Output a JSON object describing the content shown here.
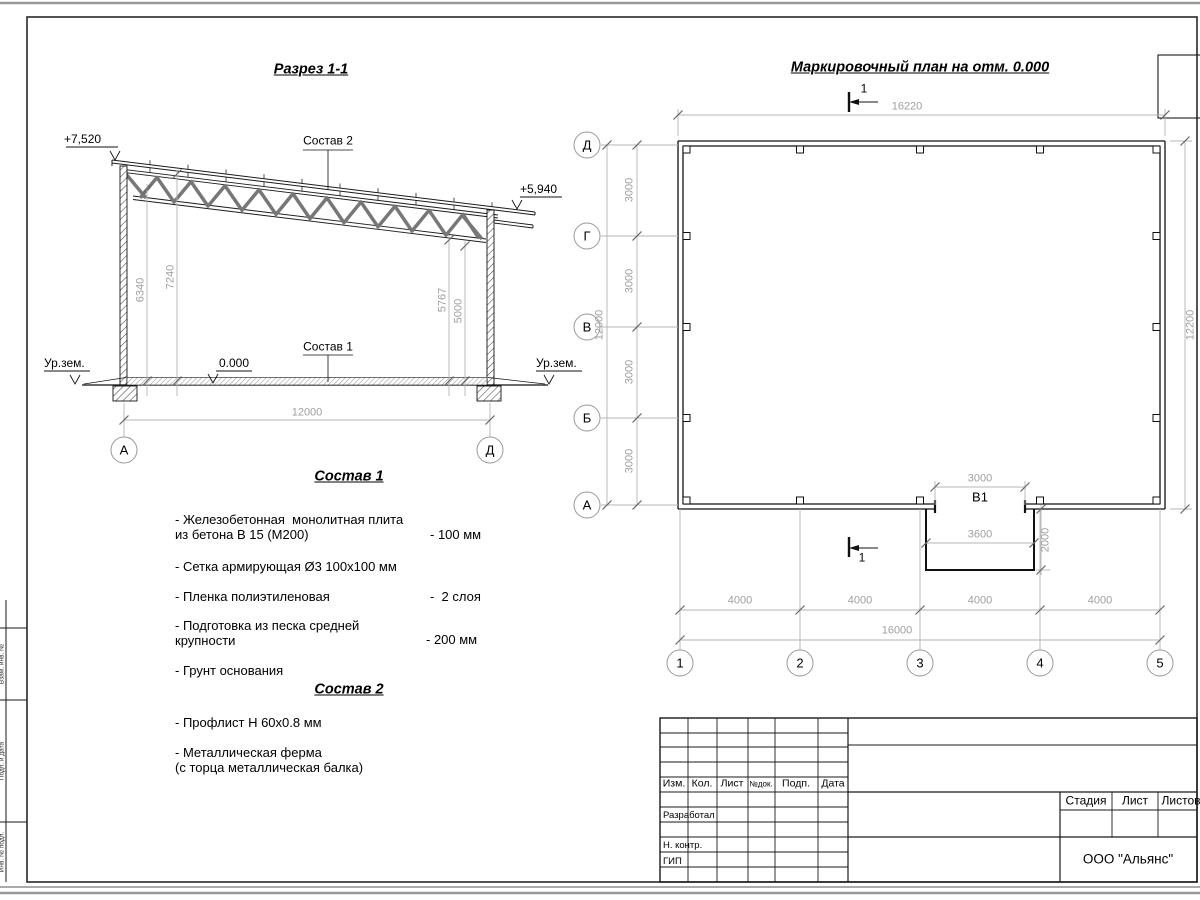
{
  "colors": {
    "line": "#1a1a1a",
    "dim": "#9e9e9e",
    "truss": "#777777"
  },
  "section": {
    "title": "Разрез 1-1",
    "elev_left": "+7,520",
    "elev_right": "+5,940",
    "label_top": "Состав 2",
    "label_floor": "Состав 1",
    "zero": "0.000",
    "ground_left": "Ур.зем.",
    "ground_right": "Ур.зем.",
    "dim_left_inner": "6340",
    "dim_left_outer": "7240",
    "dim_right_inner": "5767",
    "dim_right_outer": "5000",
    "dim_span": "12000",
    "axis_left": "А",
    "axis_right": "Д"
  },
  "composition1": {
    "heading": "Состав 1",
    "item1": "- Железобетонная  монолитная плита\nиз бетона В 15 (М200)",
    "item1_value": "- 100 мм",
    "item2": "- Сетка армирующая Ø3 100х100 мм",
    "item3": "- Пленка полиэтиленовая",
    "item3_value": "-  2 слоя",
    "item4": "- Подготовка из песка средней\nкрупности",
    "item4_value": "- 200 мм",
    "item5": "- Грунт основания"
  },
  "composition2": {
    "heading": "Состав 2",
    "item1": "- Профлист Н 60х0.8 мм",
    "item2": "- Металлическая ферма\n(с торца металлическая балка)"
  },
  "plan": {
    "title": "Маркировочный план на отм. 0.000",
    "cut_mark": "1",
    "dim_width_total": "16220",
    "dim_height_total": "12200",
    "dim_left_overall": "12000",
    "bays_left": [
      "3000",
      "3000",
      "3000",
      "3000"
    ],
    "bays_bottom": [
      "4000",
      "4000",
      "4000",
      "4000"
    ],
    "dim_bottom_overall": "16000",
    "gate_label": "В1",
    "gate_width": "3000",
    "platform_width": "3600",
    "platform_depth": "2000",
    "axes_letters": [
      "Д",
      "Г",
      "В",
      "Б",
      "А"
    ],
    "axes_numbers": [
      "1",
      "2",
      "3",
      "4",
      "5"
    ]
  },
  "title_block": {
    "col_izm": "Изм.",
    "col_kol": "Кол.",
    "col_list": "Лист",
    "col_ndok": "№док.",
    "col_podp": "Подп.",
    "col_data": "Дата",
    "row_developed": "Разработал",
    "row_ncontr": "Н. контр.",
    "row_gip": "ГИП",
    "stage": "Стадия",
    "sheet": "Лист",
    "sheets": "Листов",
    "company": "ООО \"Альянс\""
  },
  "side_stamp": {
    "label1": "Взам. инв. №",
    "label2": "Подп. и дата",
    "label3": "Инв. № подл."
  }
}
